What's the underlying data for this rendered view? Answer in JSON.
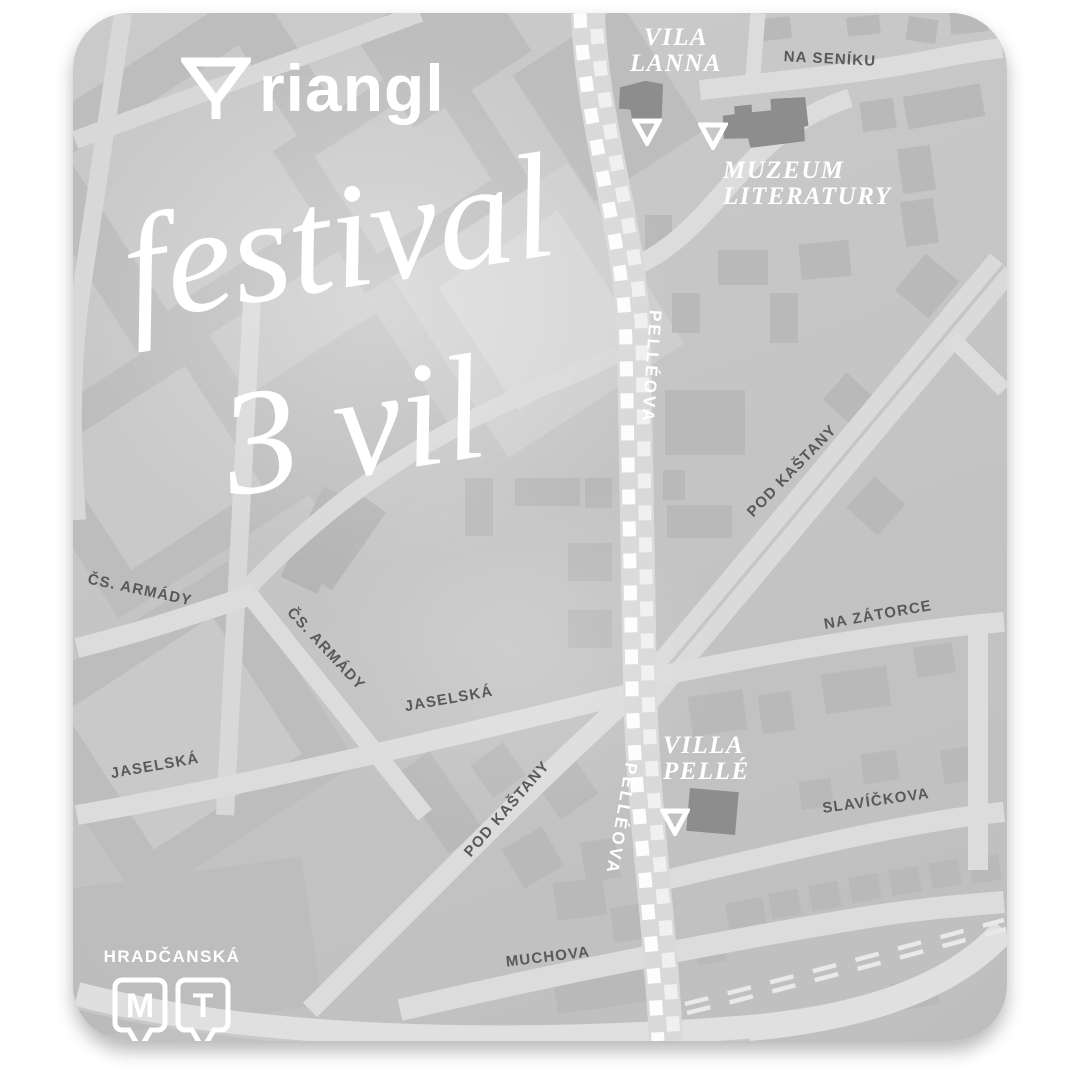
{
  "poster": {
    "brand": {
      "logo_text": "riangl",
      "logo_mark": "triangle-down"
    },
    "title": {
      "line1": "festival",
      "line2": "3 vil"
    }
  },
  "venues": [
    {
      "name_line1": "VILA",
      "name_line2": "LANNA"
    },
    {
      "name_line1": "MUZEUM",
      "name_line2": "LITERATURY"
    },
    {
      "name_line1": "VILLA",
      "name_line2": "PELLÉ"
    }
  ],
  "streets": [
    {
      "text": "NA SENÍKU"
    },
    {
      "text": "PELLÉOVA"
    },
    {
      "text": "PELLÉOVA"
    },
    {
      "text": "POD KAŠTANY"
    },
    {
      "text": "POD KAŠTANY"
    },
    {
      "text": "NA ZÁTORCE"
    },
    {
      "text": "SLAVÍČKOVA"
    },
    {
      "text": "MUCHOVA"
    },
    {
      "text": "JASELSKÁ"
    },
    {
      "text": "JASELSKÁ"
    },
    {
      "text": "ČS. ARMÁDY"
    },
    {
      "text": "ČS. ARMÁDY"
    }
  ],
  "transit": {
    "station": "HRADČANSKÁ",
    "badges": [
      {
        "label": "M"
      },
      {
        "label": "T"
      }
    ]
  },
  "colors": {
    "map_base": "#c6c6c6",
    "road": "#dcdcdc",
    "block": "#bdbdbd",
    "building": "#b9b9b9",
    "venue_building": "#8d8d8d",
    "street_text": "#595959",
    "label_white": "#ffffff"
  }
}
